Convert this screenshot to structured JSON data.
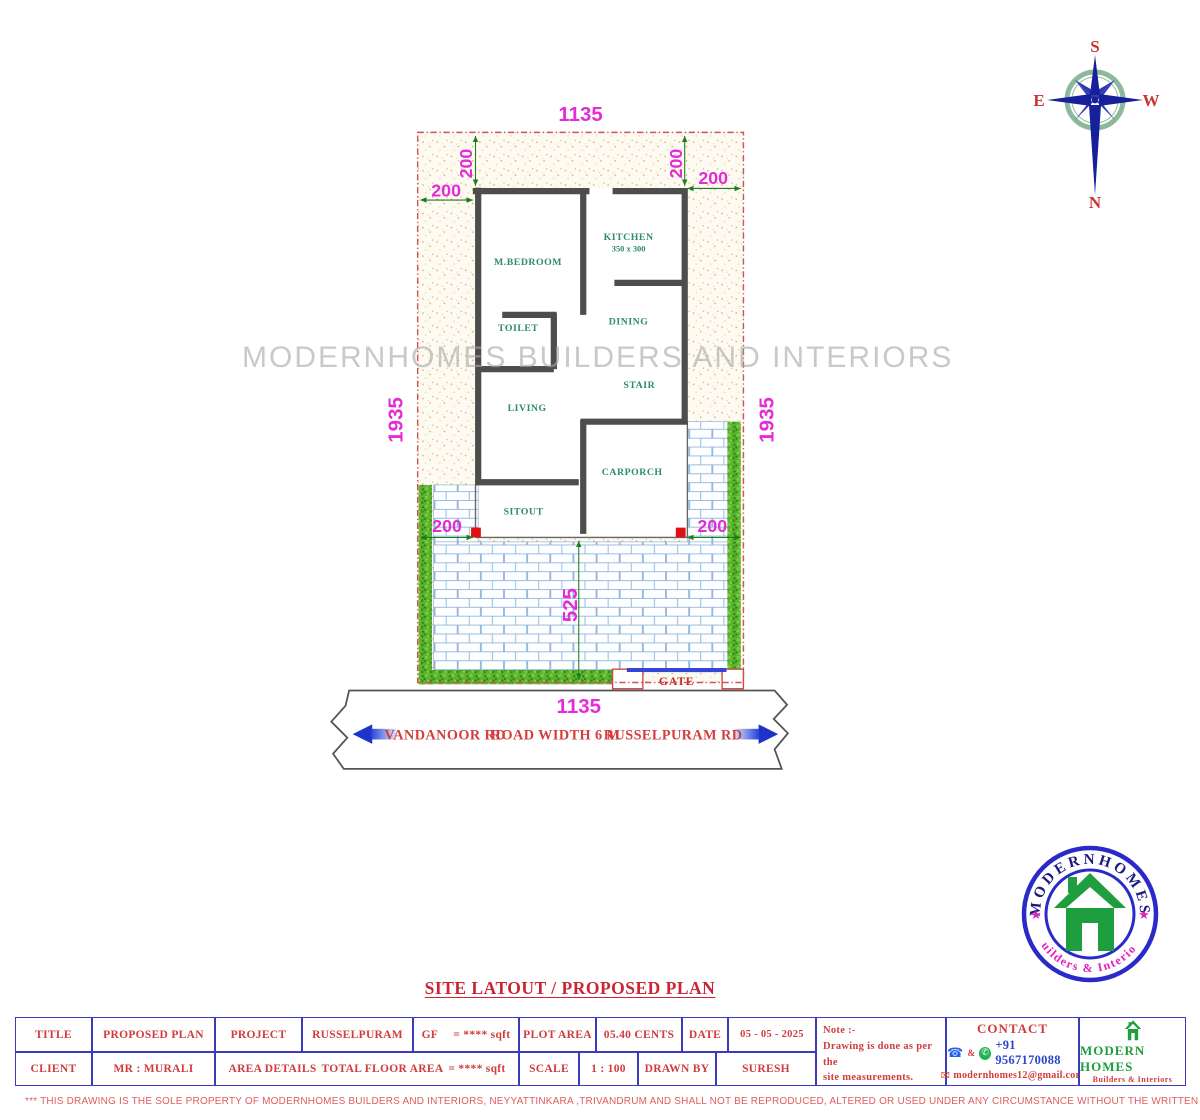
{
  "watermark": "MODERNHOMES BUILDERS AND INTERIORS",
  "sheet_title": "SITE LATOUT / PROPOSED PLAN",
  "compass": {
    "n": "N",
    "s": "S",
    "e": "E",
    "w": "W"
  },
  "plan": {
    "rooms": {
      "mbedroom": "M.BEDROOM",
      "kitchen": "KITCHEN",
      "kitchen_size": "350 x 300",
      "toilet": "TOILET",
      "dining": "DINING",
      "stair": "STAIR",
      "living": "LIVING",
      "carporch": "CARPORCH",
      "sitout": "SITOUT",
      "gate": "GATE"
    },
    "dims": {
      "w_top": "1135",
      "w_bottom": "1135",
      "h_left": "1935",
      "h_right": "1935",
      "s200_tl_v": "200",
      "s200_tl_h": "200",
      "s200_tr_v": "200",
      "s200_tr_h": "200",
      "s200_bl": "200",
      "s200_br": "200",
      "front_depth": "525"
    }
  },
  "road": {
    "dim": "1135",
    "left_name": "VANDANOOR  RD",
    "center_label": "ROAD WIDTH 6 M",
    "right_name": "RUSSELPURAM RD"
  },
  "logo_badge": {
    "top": "MODERNHOMES",
    "bottom": "Builders & Interiors",
    "star": "★"
  },
  "title_block": {
    "row1": {
      "title_label": "TITLE",
      "title_value": "PROPOSED PLAN",
      "project_label": "PROJECT",
      "project_value": "RUSSELPURAM",
      "gf_label": "GF",
      "gf_value": "= **** sqft",
      "plot_area_label": "PLOT AREA",
      "plot_area_value": "05.40  CENTS",
      "date_label": "DATE",
      "date_value": "05 - 05 - 2025"
    },
    "row2": {
      "client_label": "CLIENT",
      "client_value": "MR : MURALI",
      "area_details_label": "AREA DETAILS",
      "total_floor_label": "TOTAL FLOOR AREA",
      "total_floor_value": "= **** sqft",
      "scale_label": "SCALE",
      "scale_value": "1 : 100",
      "drawn_by_label": "DRAWN BY",
      "drawn_by_value": "SURESH"
    },
    "note": {
      "heading": "Note :-",
      "line1": "Drawing is done as per the",
      "line2": "site measurements."
    },
    "contact": {
      "heading": "CONTACT",
      "amp": "&",
      "phone": "+91 9567170088",
      "email": "modernhomes12@gmail.com",
      "icons": {
        "phone": "☎",
        "whatsapp": "✆",
        "email": "✉"
      }
    },
    "brand": {
      "name": "MODERN HOMES",
      "tagline": "Builders & Interiors"
    }
  },
  "disclaimer": "*** THIS DRAWING IS THE SOLE PROPERTY OF MODERNHOMES BUILDERS AND INTERIORS, NEYYATTINKARA ,TRIVANDRUM AND SHALL NOT BE REPRODUCED, ALTERED OR USED UNDER ANY CIRCUMSTANCE WITHOUT THE WRITTEN CONSENT OF THE AUTHORITIES.",
  "colors": {
    "dimension_magenta": "#e32bd6",
    "dimension_line_green": "#1b7d1b",
    "boundary_red": "#cc5555",
    "wall_gray": "#4d4d4d",
    "room_label_teal": "#2e8b6b",
    "brick_blue": "#8fb4d8",
    "hedge_green": "#5cb32e",
    "table_border_blue": "#3c3cba",
    "table_text_red": "#d03c3c",
    "logo_navy": "#1a1a80",
    "logo_green": "#1e9e3e",
    "logo_magenta": "#e11fc2"
  }
}
